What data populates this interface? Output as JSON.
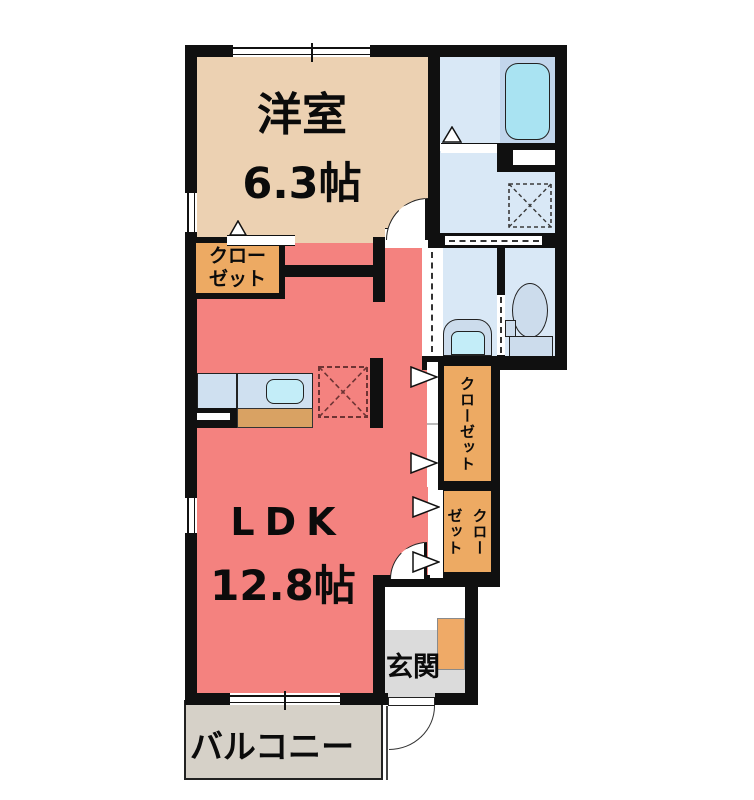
{
  "plan": {
    "western_room": {
      "label": "洋室",
      "area": "6.3帖"
    },
    "ldk": {
      "label": "LDK",
      "area": "12.8帖"
    },
    "closet_upper_left": {
      "line1": "クロー",
      "line2": "ゼット"
    },
    "closet_hall_tall": {
      "label": "クローゼット"
    },
    "closet_hall_lower": {
      "left_column": "ゼット",
      "right_column": "クロー"
    },
    "entrance": {
      "label": "玄関"
    },
    "balcony": {
      "label": "バルコニー"
    }
  },
  "colors": {
    "wall": "#101010",
    "western_room": "#ecd1b2",
    "ldk": "#f4827f",
    "closet": "#edaa63",
    "wet_area": "#d9e8f6",
    "tub_zone": "#c2d6ec",
    "tub": "#a9e3f2",
    "fixture_body": "#ccdcec",
    "sink": "#c3edf8",
    "counter": "#cfe0f0",
    "counter_front": "#d9a263",
    "shoe_cabinet": "#efaa67",
    "entrance_floor": "#dbdbdb",
    "balcony": "#d6d1c8"
  }
}
